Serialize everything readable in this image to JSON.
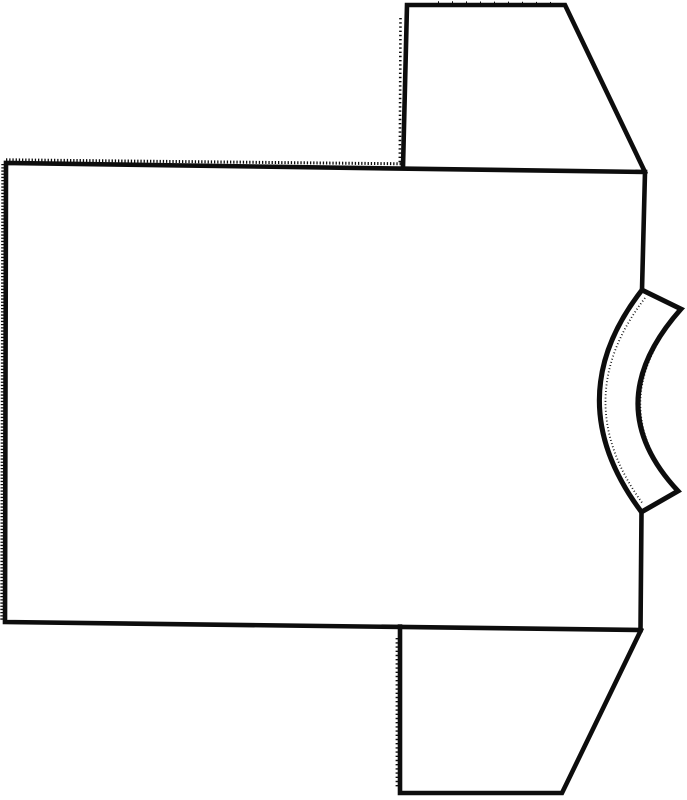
{
  "figure": {
    "title": "T-shirt outline drawing",
    "description": "Black-and-white line drawing of a short-sleeved T-shirt lying sideways: large body panel on the left, two trapezoidal sleeves extending to the top-right and bottom-right, and a curved neckband strip bulging from the right edge. The left and top seam edges are serrated (pinked) and the neckband edges are slightly fuzzy.",
    "canvas": {
      "width": 687,
      "height": 800,
      "background": "#ffffff",
      "ink": "#0d0d0d"
    },
    "shapes": [
      {
        "name": "torso-panel-outline",
        "d": "M641.5,512 L640.5,630 L5,622 L6,163 L645,172 L642,290",
        "width": 4.6,
        "cap": "square"
      },
      {
        "name": "shoulder-edge-serration",
        "d": "M6,159.8 L403,163.8",
        "width": 3,
        "dash": "1.3,1.9"
      },
      {
        "name": "hem-edge-serration",
        "d": "M2.8,164 L1.8,621",
        "width": 3,
        "dash": "1.3,1.9"
      },
      {
        "name": "neckband-inner-arc",
        "d": "M642,290 Q557,399 641.5,512",
        "width": 5,
        "cap": "butt"
      },
      {
        "name": "neckband-outer-edge",
        "d": "M642,290 L681,309 Q596.5,404 678,491 L641.5,512",
        "width": 5,
        "cap": "square"
      },
      {
        "name": "neckband-inner-fuzz",
        "d": "M645,298 Q567,400 643,504",
        "width": 1.8,
        "dash": "0.9,2.4"
      },
      {
        "name": "neckband-outer-fuzz",
        "d": "M677.5,314 Q605,404 674,486",
        "width": 1.8,
        "dash": "0.9,2.4"
      },
      {
        "name": "upper-sleeve-outline",
        "d": "M403,167 L407,5 L565,5 L645,172",
        "width": 4.6,
        "cap": "square"
      },
      {
        "name": "upper-sleeve-seam-serration",
        "d": "M400.5,18 L399.8,164",
        "width": 2.6,
        "dash": "1.4,2.8"
      },
      {
        "name": "upper-sleeve-hem-ticks",
        "d": "M438,2.2 L560,3",
        "width": 2,
        "dash": "1,13"
      },
      {
        "name": "lower-sleeve-outline",
        "d": "M400,626.5 L400,793 L562,793 L641,630",
        "width": 4.6,
        "cap": "square"
      },
      {
        "name": "lower-sleeve-seam-serration",
        "d": "M396.9,638 L396.9,789",
        "width": 2.6,
        "dash": "1.4,2.8"
      }
    ]
  }
}
